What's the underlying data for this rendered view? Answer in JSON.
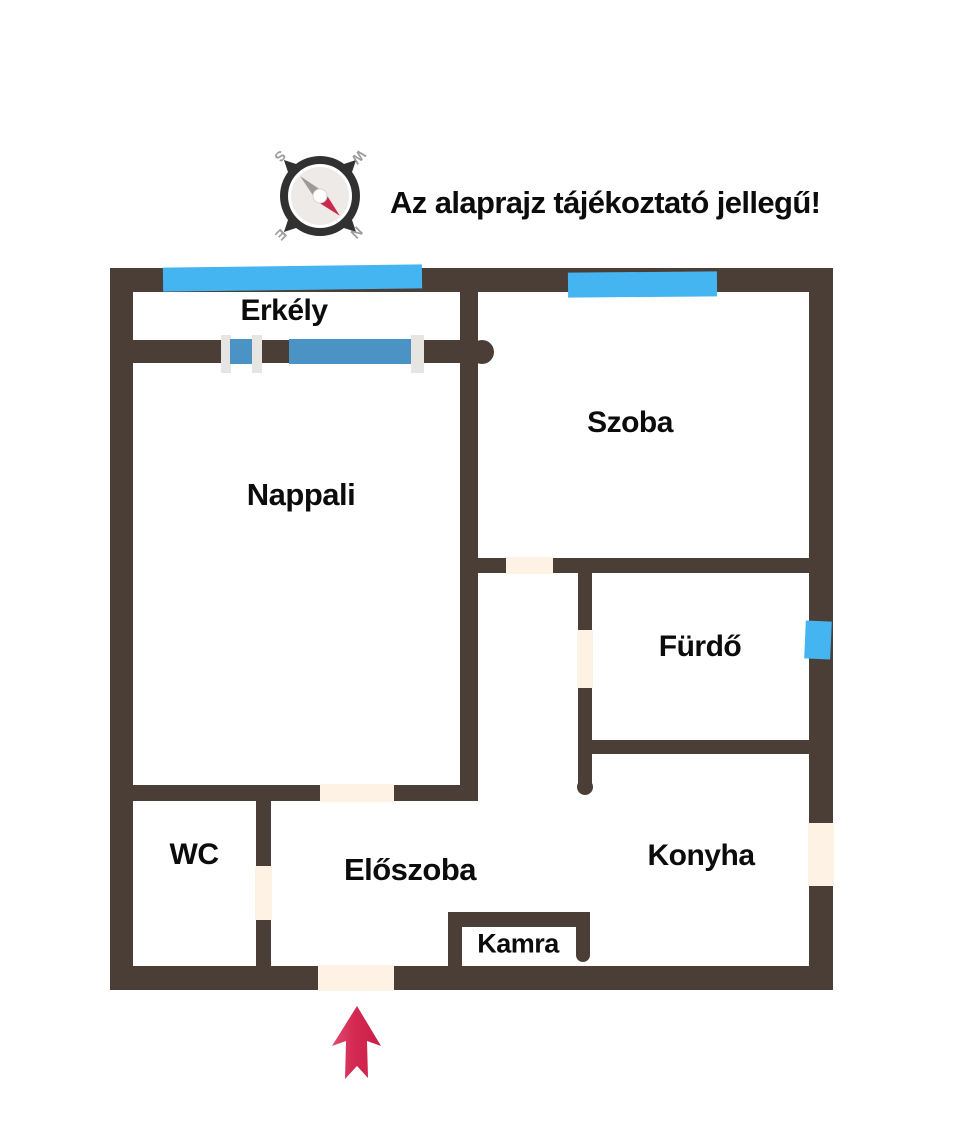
{
  "title": "Az alaprajz tájékoztató jellegű!",
  "compass": {
    "icon": "compass-icon",
    "north": "N",
    "east": "E",
    "south": "S",
    "west": "W"
  },
  "rooms": {
    "erkely": "Erkély",
    "szoba": "Szoba",
    "nappali": "Nappali",
    "furdo": "Fürdő",
    "wc": "WC",
    "eloszoba": "Előszoba",
    "konyha": "Konyha",
    "kamra": "Kamra"
  },
  "icons": {
    "entrance_arrow": "entrance-arrow-icon"
  },
  "colors": {
    "wall": "#4a3e36",
    "window_blue": "#45b5f2",
    "balcony_door_blue": "#4a93c4",
    "window_frame_white": "#e7e5e2",
    "door_opening_cream": "#fdf2e4",
    "entrance_arrow_red": "#d32952",
    "compass_ring": "#313131",
    "compass_needle_red": "#c82a4e",
    "compass_needle_gray": "#9b9895",
    "compass_letters": "#9b9b9b"
  }
}
